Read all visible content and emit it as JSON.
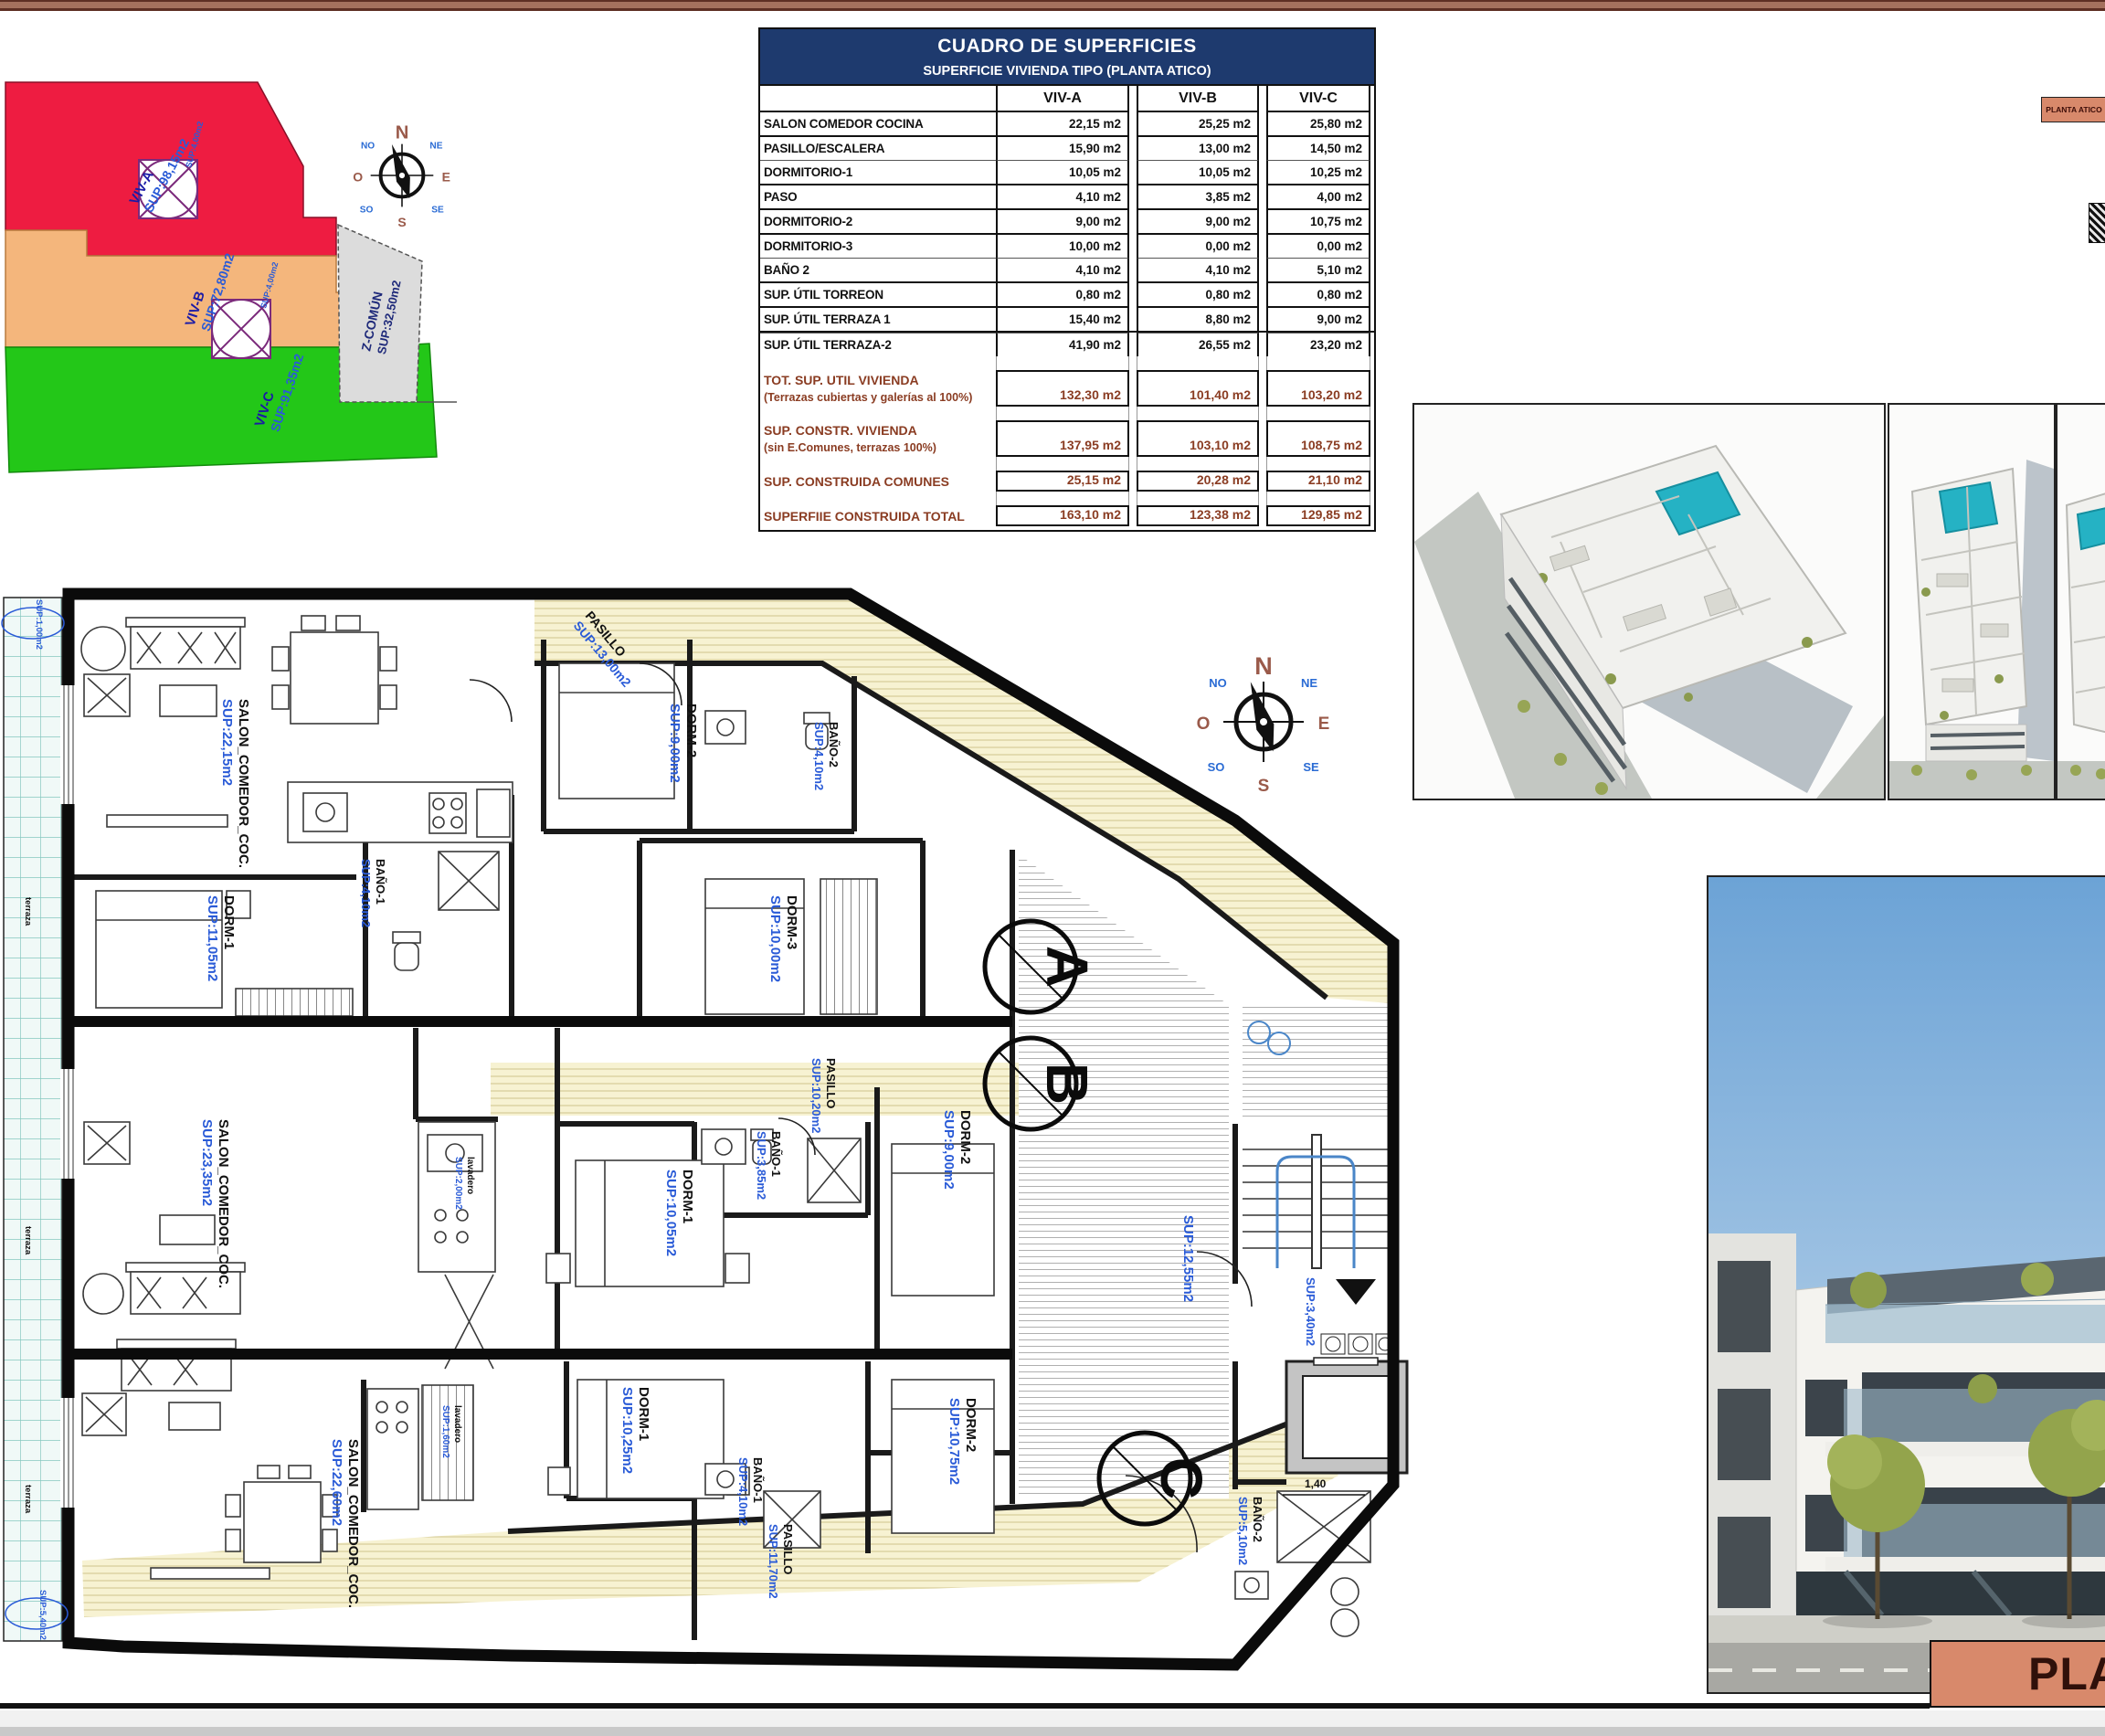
{
  "page": {
    "sheet_title": "PLA",
    "corner_tag": "PLANTA ATICO"
  },
  "colors": {
    "accent_red": "#ee1c41",
    "accent_orange": "#f4b67c",
    "accent_green": "#23c718",
    "accent_navy": "#1e3a6e",
    "accent_brown": "#8a3c22",
    "accent_blue": "#2a5bd7",
    "bar_brown": "#a5715e",
    "pool_teal": "#25b2c4",
    "title_salmon": "#d8896b"
  },
  "table": {
    "title": "CUADRO DE SUPERFICIES",
    "subtitle": "SUPERFICIE VIVIENDA TIPO  (PLANTA ATICO)",
    "columns": [
      "VIV-A",
      "VIV-B",
      "VIV-C"
    ],
    "rows": [
      {
        "label": "SALON COMEDOR COCINA",
        "a": "22,15 m2",
        "b": "25,25 m2",
        "c": "25,80 m2"
      },
      {
        "label": "PASILLO/ESCALERA",
        "a": "15,90 m2",
        "b": "13,00 m2",
        "c": "14,50 m2"
      },
      {
        "label": "DORMITORIO-1",
        "a": "10,05 m2",
        "b": "10,05 m2",
        "c": "10,25 m2"
      },
      {
        "label": "PASO",
        "a": "4,10 m2",
        "b": "3,85 m2",
        "c": "4,00 m2"
      },
      {
        "label": "DORMITORIO-2",
        "a": "9,00 m2",
        "b": "9,00 m2",
        "c": "10,75 m2"
      },
      {
        "label": "DORMITORIO-3",
        "a": "10,00 m2",
        "b": "0,00 m2",
        "c": "0,00 m2"
      },
      {
        "label": "BAÑO 2",
        "a": "4,10 m2",
        "b": "4,10 m2",
        "c": "5,10 m2"
      },
      {
        "label": "SUP. ÚTIL TORREON",
        "a": "0,80 m2",
        "b": "0,80 m2",
        "c": "0,80 m2"
      },
      {
        "label": "SUP. ÚTIL TERRAZA 1",
        "a": "15,40 m2",
        "b": "8,80 m2",
        "c": "9,00 m2"
      },
      {
        "label": "SUP. ÚTIL TERRAZA-2",
        "a": "41,90 m2",
        "b": "26,55 m2",
        "c": "23,20 m2"
      }
    ],
    "summary": [
      {
        "label": "TOT. SUP. UTIL VIVIENDA",
        "sublabel": "(Terrazas cubiertas y galerías al 100%)",
        "a": "132,30 m2",
        "b": "101,40 m2",
        "c": "103,20 m2"
      },
      {
        "label": "SUP. CONSTR. VIVIENDA",
        "sublabel": "(sin E.Comunes, terrazas 100%)",
        "a": "137,95 m2",
        "b": "103,10 m2",
        "c": "108,75 m2"
      },
      {
        "label": "SUP. CONSTRUIDA COMUNES",
        "sublabel": "",
        "a": "25,15 m2",
        "b": "20,28 m2",
        "c": "21,10 m2"
      },
      {
        "label": "SUPERFIIE CONSTRUIDA TOTAL",
        "sublabel": "",
        "a": "163,10 m2",
        "b": "123,38 m2",
        "c": "129,85 m2"
      }
    ]
  },
  "site": {
    "zones": [
      {
        "name": "VIV-A",
        "sup": "SUP:98,15m2"
      },
      {
        "name": "VIV-B",
        "sup": "SUP:72,80m2"
      },
      {
        "name": "VIV-C",
        "sup": "SUP:91,35m2"
      }
    ],
    "common_name": "Z-COMÚN",
    "common_sup": "SUP:32,50m2",
    "torreon_sup": "SUP:4,00m2"
  },
  "compass": {
    "n": "N",
    "ne": "NE",
    "e": "E",
    "se": "SE",
    "s": "S",
    "so": "SO",
    "o": "O",
    "no": "NO"
  },
  "plan": {
    "markers": {
      "a": "A",
      "b": "B",
      "c": "C"
    },
    "dim_shower": "1,40",
    "terraza": "terraza",
    "labels": [
      {
        "name": "SALON_COMEDOR_COC.",
        "sup": "SUP:22,15m2"
      },
      {
        "name": "DORM-1",
        "sup": "SUP:11,05m2"
      },
      {
        "name": "BAÑO-1",
        "sup": "SUP:4,10m2"
      },
      {
        "name": "DORM-2",
        "sup": "SUP:9,00m2"
      },
      {
        "name": "BAÑO-2",
        "sup": "SUP:4,10m2"
      },
      {
        "name": "DORM-3",
        "sup": "SUP:10,00m2"
      },
      {
        "name": "PASILLO",
        "sup": "SUP:13,00m2"
      },
      {
        "name": "SALON_COMEDOR_COC.",
        "sup": "SUP:23,35m2"
      },
      {
        "name": "DORM-1",
        "sup": "SUP:10,05m2"
      },
      {
        "name": "BAÑO-1",
        "sup": "SUP:3,85m2"
      },
      {
        "name": "DORM-2",
        "sup": "SUP:9,00m2"
      },
      {
        "name": "PASILLO",
        "sup": "SUP:10,20m2"
      },
      {
        "name": "lavadero",
        "sup": "SUP:2,00m2"
      },
      {
        "name": "SALON_COMEDOR_COC.",
        "sup": "SUP:22,60m2"
      },
      {
        "name": "DORM-1",
        "sup": "SUP:10,25m2"
      },
      {
        "name": "BAÑO-1",
        "sup": "SUP:4,10m2"
      },
      {
        "name": "DORM-2",
        "sup": "SUP:10,75m2"
      },
      {
        "name": "BAÑO-2",
        "sup": "SUP:5,10m2"
      },
      {
        "name": "PASILLO",
        "sup": "SUP:11,70m2"
      },
      {
        "name": "lavadero",
        "sup": "SUP:1,60m2"
      },
      {
        "name": "",
        "sup": "SUP:12,55m2"
      },
      {
        "name": "",
        "sup": "SUP:3,40m2"
      },
      {
        "name": "",
        "sup": "SUP:1,00m2"
      },
      {
        "name": "",
        "sup": "SUP:5,40m2"
      }
    ]
  }
}
